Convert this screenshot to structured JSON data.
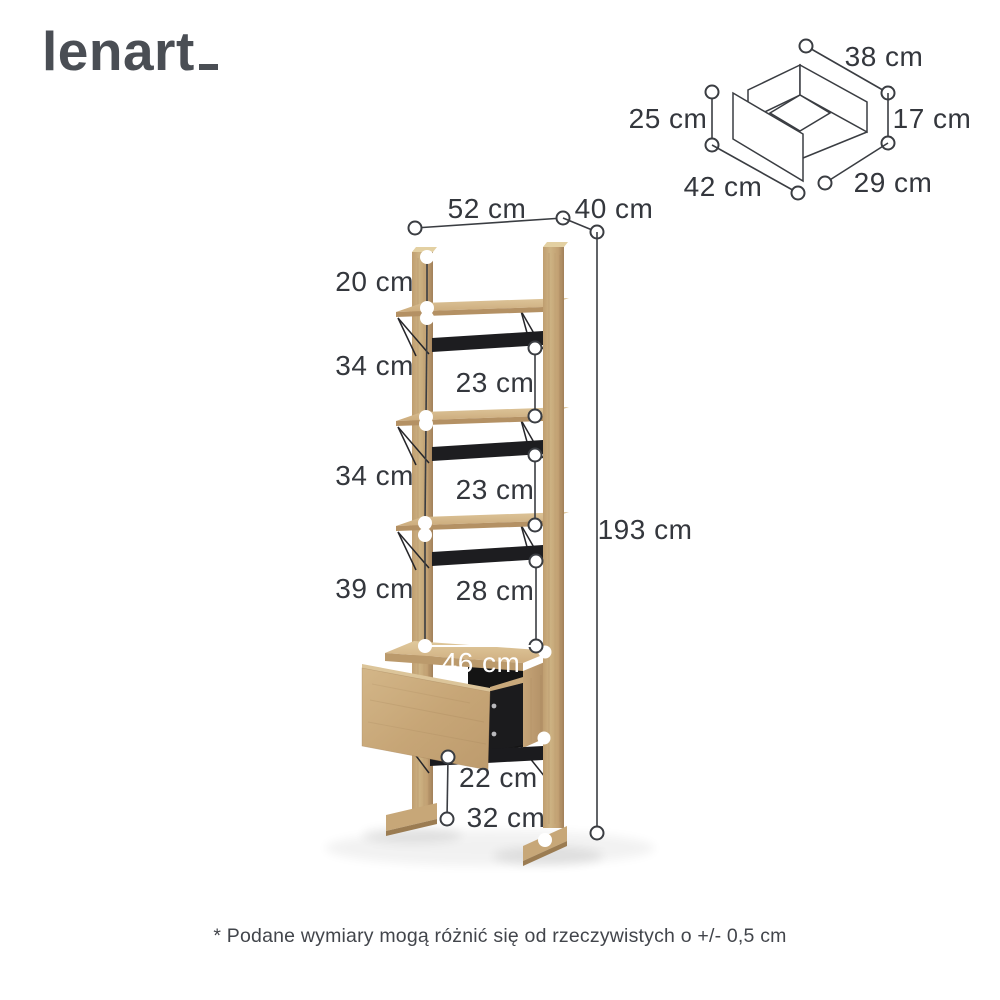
{
  "logo": {
    "text": "lenart"
  },
  "footnote": "* Podane wymiary mogą różnić się od rzeczywistych o +/- 0,5 cm",
  "colors": {
    "wood": "#c9a97b",
    "wood_light": "#dcc498",
    "wood_dark": "#a8865c",
    "metal_black": "#1d1d20",
    "dim_line": "#3a3d42",
    "label_text": "#34373d",
    "logo_text": "#4a4e54",
    "background": "#ffffff"
  },
  "main": {
    "width_top": "52 cm",
    "depth_top": "40 cm",
    "height": "193 cm",
    "top_section": "20 cm",
    "section_1": "34 cm",
    "clearance_1": "23 cm",
    "section_2": "34 cm",
    "clearance_2": "23 cm",
    "section_3": "39 cm",
    "clearance_3": "28 cm",
    "drawer_width": "46 cm",
    "base_clearance": "22 cm",
    "base_depth": "32 cm"
  },
  "drawer_box": {
    "width": "38 cm",
    "height_front": "25 cm",
    "height_side": "17 cm",
    "depth_bottom": "42 cm",
    "width_bottom": "29 cm"
  }
}
